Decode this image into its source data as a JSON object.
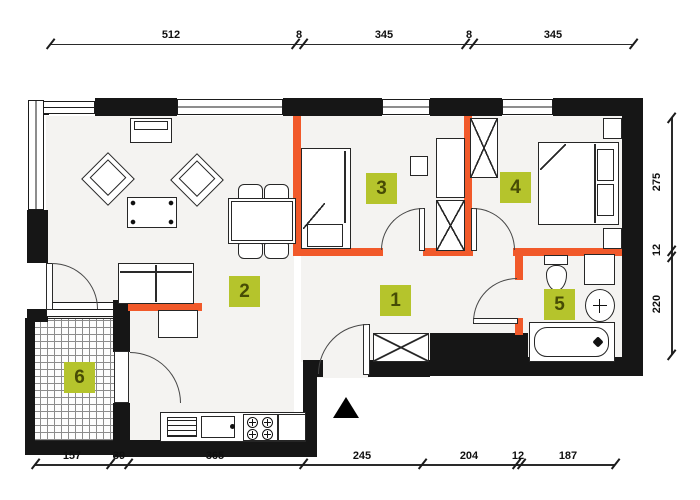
{
  "plan": {
    "type": "apartment-floor-plan",
    "rooms": [
      "1",
      "2",
      "3",
      "4",
      "5",
      "6"
    ],
    "dims": {
      "top": [
        "512",
        "8",
        "345",
        "8",
        "345"
      ],
      "right": [
        "275",
        "12",
        "220"
      ],
      "bottom": [
        "157",
        "39",
        "365",
        "245",
        "204",
        "12",
        "187"
      ]
    },
    "icons": {
      "entrance_arrow": "filled-triangle-up"
    },
    "colors": {
      "wall": "#161616",
      "accent_wall": "#f1592a",
      "room_label_bg": "#b5c42c",
      "room_label_text": "#474c05",
      "floor": "#f4f3f1",
      "dimension": "#1b1b1b"
    }
  }
}
